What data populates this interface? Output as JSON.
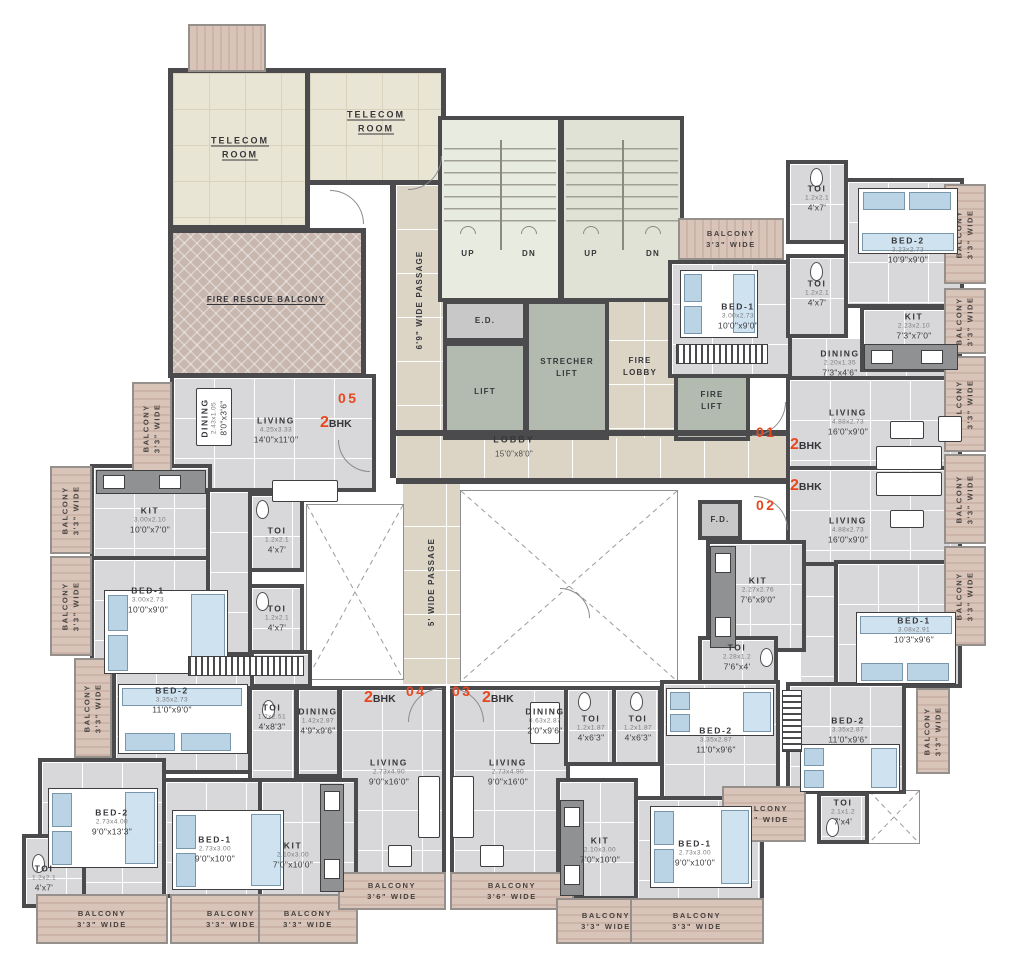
{
  "core": {
    "telecom": "TELECOM ROOM",
    "fire_rescue": "FIRE RESCUE BALCONY",
    "up": "UP",
    "dn": "DN",
    "ed": "E.D.",
    "lift": "LIFT",
    "strecher": "STRECHER LIFT",
    "fire_lobby": "FIRE LOBBY",
    "fire_lift": "FIRE LIFT",
    "fd": "F.D.",
    "lobby_name": "LOBBY",
    "lobby_dim": "15'0\"x8'0\"",
    "passage_69": "6'9\" WIDE PASSAGE",
    "passage_5": "5' WIDE PASSAGE"
  },
  "units": {
    "bhk_num": "2",
    "bhk_txt": "BHK",
    "u01": "01",
    "u02": "02",
    "u03": "03",
    "u04": "04",
    "u05": "05"
  },
  "balconies": {
    "name": "BALCONY",
    "w33": "3'3\" WIDE",
    "w36": "3'6\" WIDE",
    "w43": "4'3\" WIDE"
  },
  "rooms": {
    "l05": {
      "name": "LIVING",
      "m": "4.25x3.33",
      "ft": "14'0\"x11'0\""
    },
    "d05": {
      "name": "DINING",
      "m": "2.43x1.05",
      "ft": "8'0\"x3'6\""
    },
    "k05": {
      "name": "KIT",
      "m": "3.00x2.10",
      "ft": "10'0\"x7'0\""
    },
    "b1_1090": {
      "name": "BED-1",
      "m": "3.00x2.73",
      "ft": "10'0\"x9'0\""
    },
    "t47": {
      "name": "TOI",
      "m": "1.2x2.1",
      "ft": "4'x7'"
    },
    "b2_1090": {
      "name": "BED-2",
      "m": "3.23x2.73",
      "ft": "10'9\"x9'0\""
    },
    "k01": {
      "name": "KIT",
      "m": "2.23x2.10",
      "ft": "7'3\"x7'0\""
    },
    "d01": {
      "name": "DINING",
      "m": "2.20x1.35",
      "ft": "7'3\"x4'6\""
    },
    "l169": {
      "name": "LIVING",
      "m": "4.88x2.73",
      "ft": "16'0\"x9'0\""
    },
    "k02": {
      "name": "KIT",
      "m": "2.27x2.76",
      "ft": "7'6\"x9'0\""
    },
    "t764": {
      "name": "TOI",
      "m": "2.28x1.2",
      "ft": "7'6\"x4'"
    },
    "b102": {
      "name": "BED-1",
      "m": "3.08x2.91",
      "ft": "10'3\"x9'6\""
    },
    "b2_1196": {
      "name": "BED-2",
      "m": "3.35x2.87",
      "ft": "11'0\"x9'6\""
    },
    "t74": {
      "name": "TOI",
      "m": "2.1x1.2",
      "ft": "7'x4'"
    },
    "l916": {
      "name": "LIVING",
      "m": "2.73x4.90",
      "ft": "9'0\"x16'0\""
    },
    "d03": {
      "name": "DINING",
      "m": "0.63x2.87",
      "ft": "2'0\"x9'6\""
    },
    "t463": {
      "name": "TOI",
      "m": "1.2x1.87",
      "ft": "4'x6'3\""
    },
    "k710": {
      "name": "KIT",
      "m": "2.10x3.00",
      "ft": "7'0\"x10'0\""
    },
    "b1_910": {
      "name": "BED-1",
      "m": "2.73x3.00",
      "ft": "9'0\"x10'0\""
    },
    "d04": {
      "name": "DINING",
      "m": "1.42x2.87",
      "ft": "4'9\"x9'6\""
    },
    "t483": {
      "name": "TOI",
      "m": "1.2x2.51",
      "ft": "4'x8'3\""
    },
    "b2_1190": {
      "name": "BED-2",
      "m": "3.35x2.73",
      "ft": "11'0\"x9'0\""
    },
    "b2_9133": {
      "name": "BED-2",
      "m": "2.73x4.00",
      "ft": "9'0\"x13'3\""
    }
  }
}
